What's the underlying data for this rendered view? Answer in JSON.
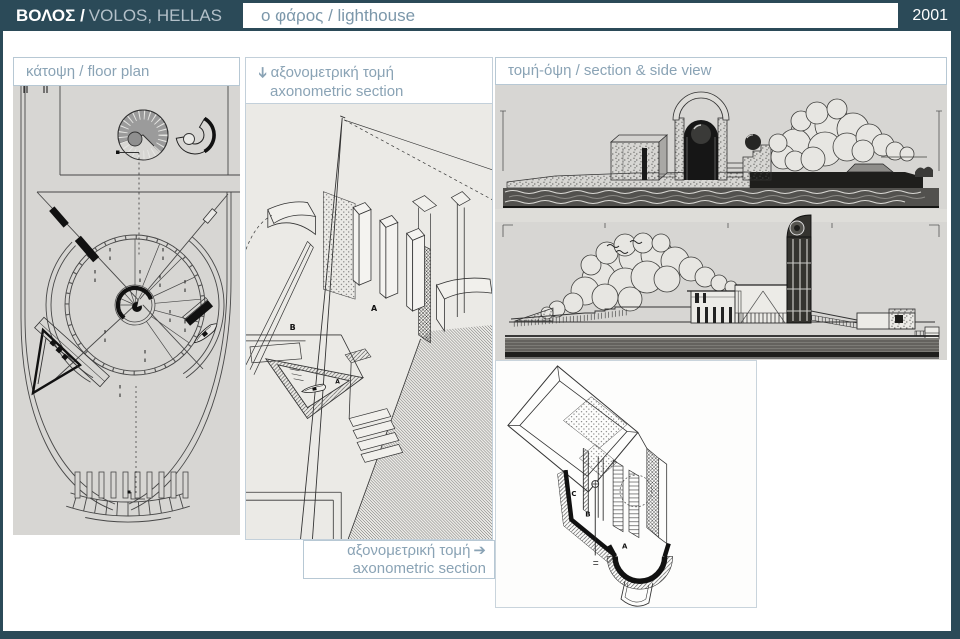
{
  "colors": {
    "frame": "#2b4a58",
    "label_text": "#8aa3b5",
    "subtitle_text": "#7b97aa",
    "panel_border": "#b7c8d4",
    "image_bg": "#d7d6d3",
    "drawing_bg": "#ebeae6"
  },
  "header": {
    "title_bold": "ΒΟΛΟΣ /",
    "title_rest": "VOLOS, HELLAS",
    "subtitle": "ο φάρος / lighthouse",
    "year": "2001"
  },
  "icons": {
    "down_arrow": "➔",
    "right_arrow": "➔"
  },
  "panels": {
    "floor_plan": {
      "label": "κάτοψη / floor plan"
    },
    "axonometric": {
      "label_greek": "αξονομετρική τομή",
      "label_english": "axonometric section",
      "markers": {
        "a": "A",
        "b": "B",
        "a_small": "A"
      }
    },
    "section": {
      "label": "τομή-όψη / section & side view"
    },
    "axon_section": {
      "label_greek": "αξονομετρική τομή",
      "label_english": "axonometric section",
      "markers": {
        "a": "A",
        "b": "B",
        "c": "C"
      }
    }
  }
}
